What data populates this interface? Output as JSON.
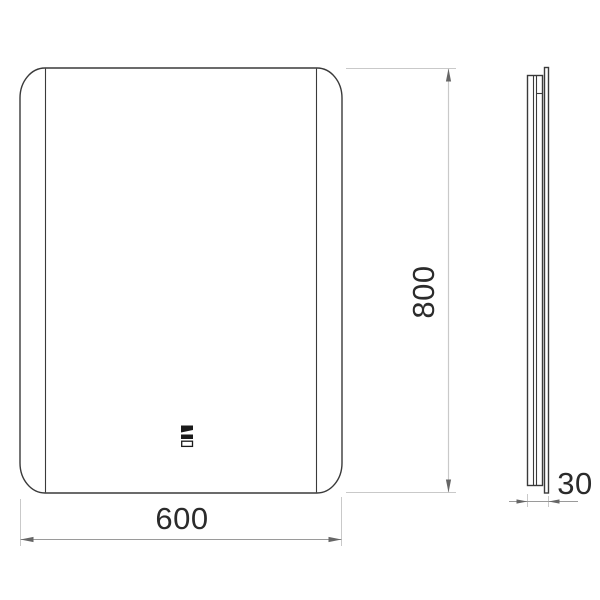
{
  "drawing": {
    "type": "technical-dimension-drawing",
    "front_view": {
      "width_label": "600",
      "height_label": "800",
      "touch_sensor_icon": "touch-sensor-icon"
    },
    "side_view": {
      "depth_label": "30"
    },
    "colors": {
      "background": "#ffffff",
      "outline": "#3a3a3a",
      "dim_line": "#9a9a9a",
      "ext_line": "#c9c9c9",
      "arrow": "#666666",
      "label_text": "#2b2b2b",
      "icon": "#1a1a1a"
    }
  }
}
